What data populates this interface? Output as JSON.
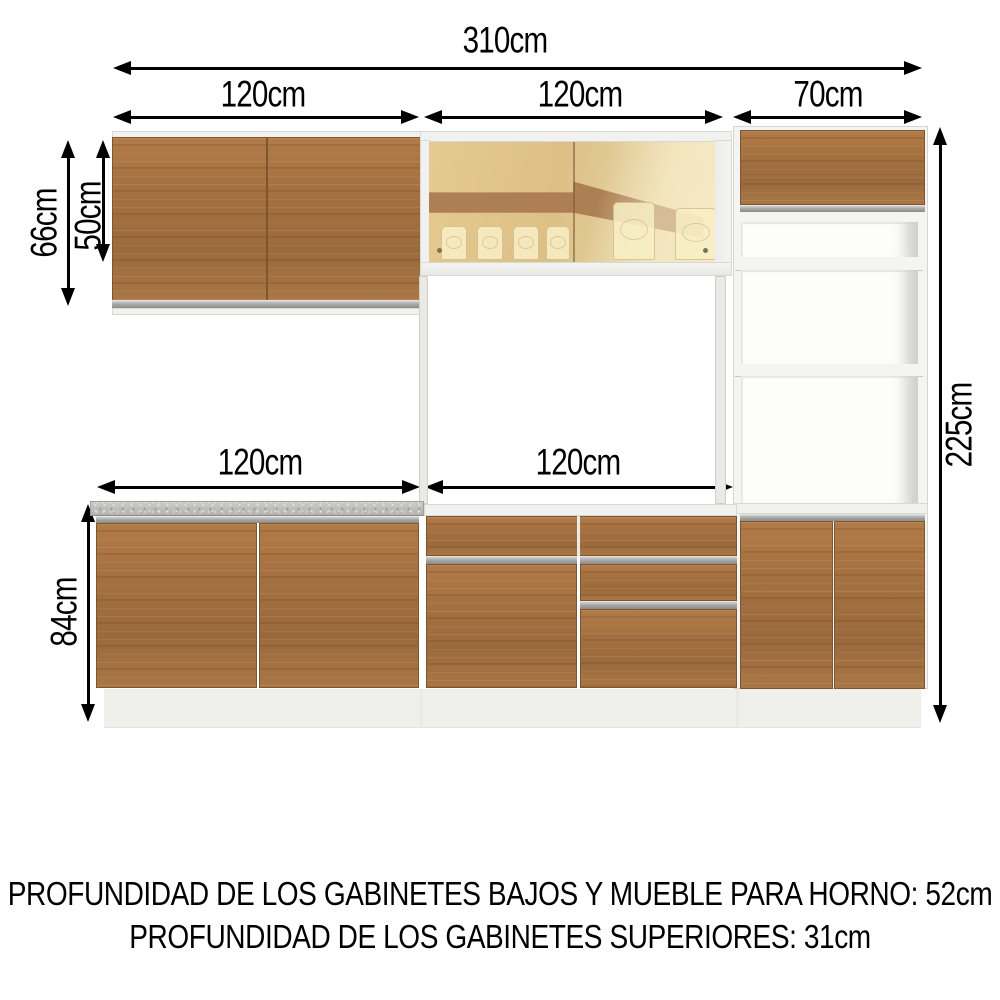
{
  "dims": {
    "total_width": "310cm",
    "upper_left_width": "120cm",
    "upper_middle_width": "120cm",
    "upper_right_width": "70cm",
    "upper_cabinet_height": "66cm",
    "upper_door_height": "50cm",
    "niche_top_height": "15cm",
    "niche_middle_height": "37cm",
    "niche_bottom_height": "54cm",
    "total_height": "225cm",
    "lower_left_width": "120cm",
    "lower_middle_width": "120cm",
    "lower_cabinet_height": "84cm"
  },
  "notes": {
    "line1": "PROFUNDIDAD DE LOS GABINETES BAJOS Y MUEBLE PARA HORNO: 52cm",
    "line2": "PROFUNDIDAD DE LOS GABINETES SUPERIORES: 31cm"
  },
  "colors": {
    "wood": "#a5713f",
    "countertop_granite": "#bdbdb9",
    "handle_metal": "#9b9b99",
    "cabinet_white": "#f1f1ef",
    "glass_amber": "#e0c48d",
    "annotation": "#000000",
    "background": "#ffffff"
  }
}
